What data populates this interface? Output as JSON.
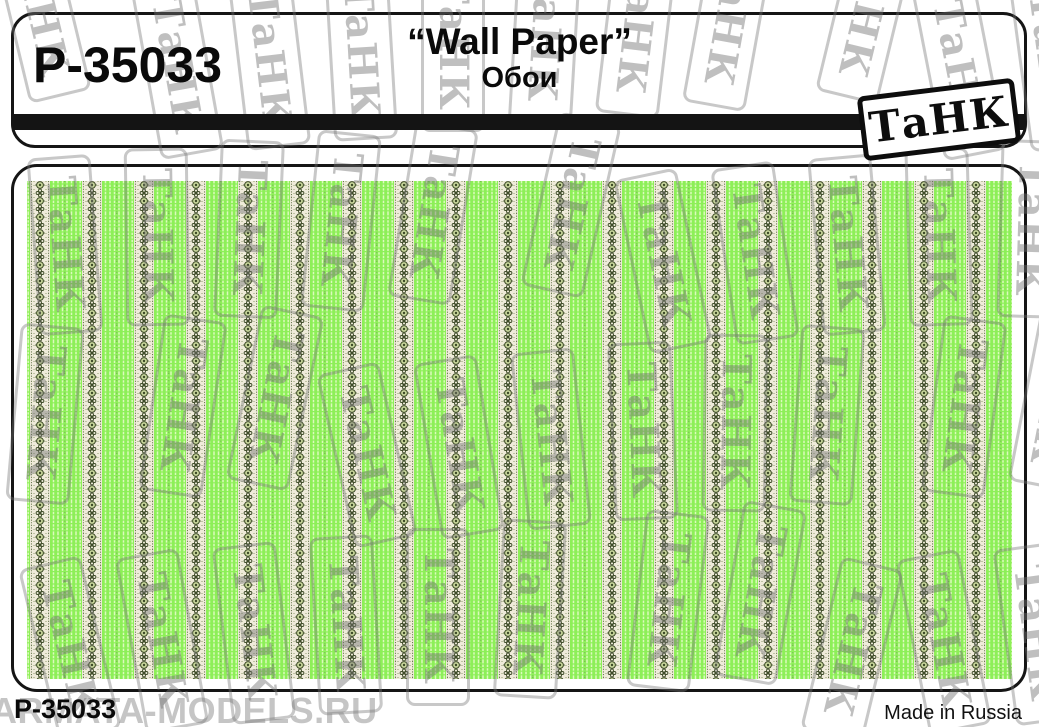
{
  "header": {
    "product_code": "P-35033",
    "title": "“Wall Paper”",
    "subtitle": "Обои",
    "brand_logo": "ТаНК"
  },
  "footer": {
    "product_code": "P-35033",
    "made_in": "Made in Russia"
  },
  "watermark": {
    "stamp_text": "ТаНК",
    "site_text": "ARMATA-MODELS.RU"
  },
  "pattern": {
    "description": "Green vertical-striped wallpaper with cream floral ornament bands",
    "colors": {
      "green": "#8DEF58",
      "light_stripe": "#DCFABC",
      "cream": "#EFEBDA",
      "ornament_dark": "#3C4A26",
      "rosette_fill": "#C8D69B",
      "dot_accent": "#6E7E49"
    }
  }
}
